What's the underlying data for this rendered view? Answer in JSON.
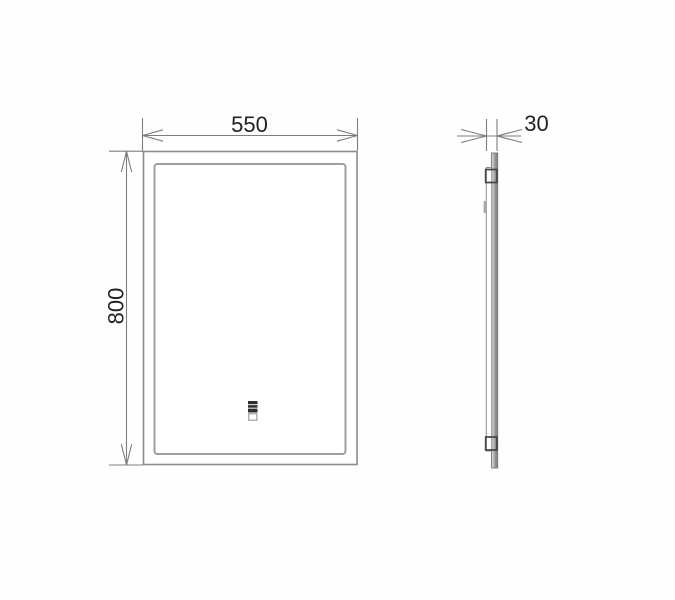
{
  "drawing": {
    "type": "technical-dimension-drawing",
    "subject": "led-mirror",
    "front_view": {
      "width_label": "550",
      "height_label": "800"
    },
    "side_view": {
      "depth_label": "30"
    },
    "icons": [
      "touch-sensor-icon"
    ],
    "colors": {
      "background": "#fefefe",
      "dimension_line": "#7d7d7d",
      "outer_frame": "#8c8c8c",
      "inner_frame": "#9e9e9e",
      "text": "#222222",
      "bracket": "#4a4a4a",
      "glass_edge": "#777777",
      "sensor_dark": "#2e2e2e",
      "sensor_light": "#cfcfcf"
    }
  }
}
